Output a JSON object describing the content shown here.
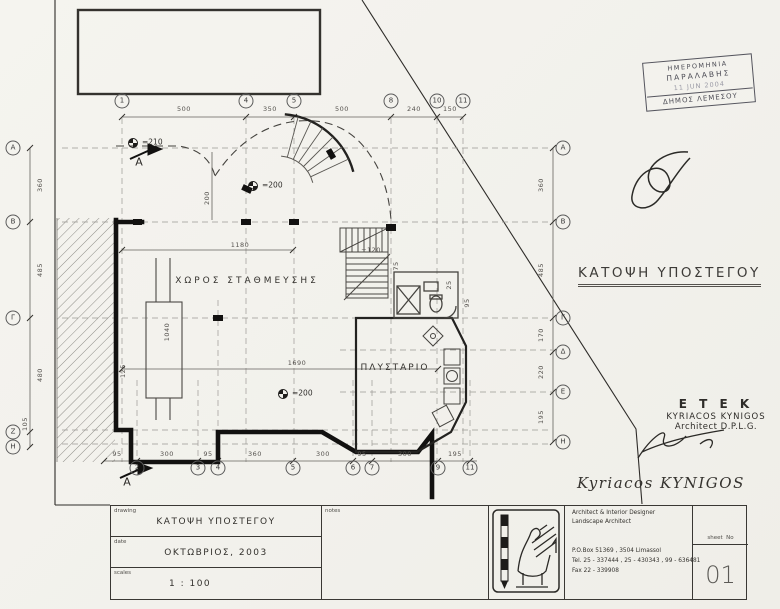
{
  "stamp": {
    "line1": "ΗΜΕΡΟΜΗΝΙΑ",
    "line2": "ΠΑΡΑΛΑΒΗΣ",
    "date": "11 JUN 2004",
    "municipality": "ΔΗΜΟΣ ΛΕΜΕΣΟΥ"
  },
  "plan": {
    "heading": "ΚΑΤΟΨΗ ΥΠΟΣΤΕΓΟΥ",
    "room_parking": "ΧΩΡΟΣ ΣΤΑΘΜΕΥΣΗΣ",
    "room_laundry": "ΠΛΥΣΤΑΡΙΟ",
    "section_a": "A",
    "level_210": "=210",
    "level_200a": "=200",
    "level_200b": "=200",
    "stair_level": "+120"
  },
  "grid": {
    "top_bubbles": [
      "1",
      "4",
      "5",
      "8",
      "10",
      "11"
    ],
    "top_dims": [
      "500",
      "350",
      "500",
      "240",
      "150"
    ],
    "bottom_bubbles": [
      "2",
      "3",
      "4",
      "5",
      "6",
      "7",
      "9",
      "11"
    ],
    "bottom_dims": [
      "95",
      "300",
      "95",
      "360",
      "300",
      "95",
      "300",
      "195"
    ],
    "left_bubbles": [
      "A",
      "B",
      "Γ",
      "Z",
      "H"
    ],
    "left_dims": [
      "360",
      "485",
      "480",
      "105"
    ],
    "right_bubbles": [
      "A",
      "B",
      "Γ",
      "Δ",
      "E",
      "H"
    ],
    "right_dims": [
      "360",
      "485",
      "170",
      "220",
      "195"
    ]
  },
  "dims": {
    "w1180": "1180",
    "w200": "200",
    "w1040": "1040",
    "w1690": "1690",
    "w125": "125",
    "w75": "75",
    "w25": "25",
    "w95": "95"
  },
  "architect": {
    "org": "E T E K",
    "name": "KYRIACOS KYNIGOS",
    "title": "Architect D.P.L.G.",
    "signature": "Kyriacos  KYNIGOS"
  },
  "titleblock": {
    "drawing_label": "drawing",
    "drawing_value": "ΚΑΤΟΨΗ ΥΠΟΣΤΕΓΟΥ",
    "date_label": "date",
    "date_value": "ΟΚΤΩΒΡΙΟΣ, 2003",
    "scales_label": "scales",
    "scales_value": "1 : 100",
    "notes_label": "notes",
    "firm_line1": "Architect & Interior Designer",
    "firm_line2": "Landscape Architect",
    "address": "P.O.Box 51369 , 3504 Limassol",
    "tel": "Tel. 25 - 337444 , 25 - 430343 , 99 - 636481",
    "fax": "Fax 22 - 339908",
    "sheet_label": "sheet  No",
    "sheet_value": "01"
  }
}
